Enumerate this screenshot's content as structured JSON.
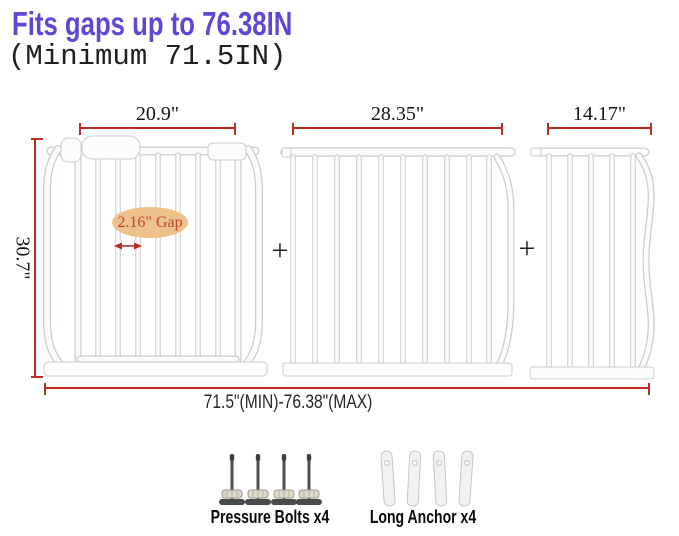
{
  "header": {
    "title": "Fits gaps up to 76.38IN",
    "subtitle": "(Minimum 71.5IN)"
  },
  "diagram": {
    "panels": [
      {
        "id": "walk-through-gate",
        "width_label": "20.9\""
      },
      {
        "id": "extension-panel-wide",
        "width_label": "28.35\""
      },
      {
        "id": "extension-panel-narrow",
        "width_label": "14.17\""
      }
    ],
    "height_label": "30.7\"",
    "range_label": "71.5\"(MIN)-76.38\"(MAX)",
    "gap_label": "2.16\" Gap",
    "plus_sign": "+"
  },
  "accessories": [
    {
      "label": "Pressure Bolts x4"
    },
    {
      "label": "Long Anchor x4"
    }
  ],
  "colors": {
    "title": "#5b49d3",
    "dimension": "#bf2c24",
    "gap-fill": "#edc189",
    "gap-text": "#c2452f",
    "bar-stroke": "#cccccc",
    "bar-fill": "#fcfcfc"
  }
}
